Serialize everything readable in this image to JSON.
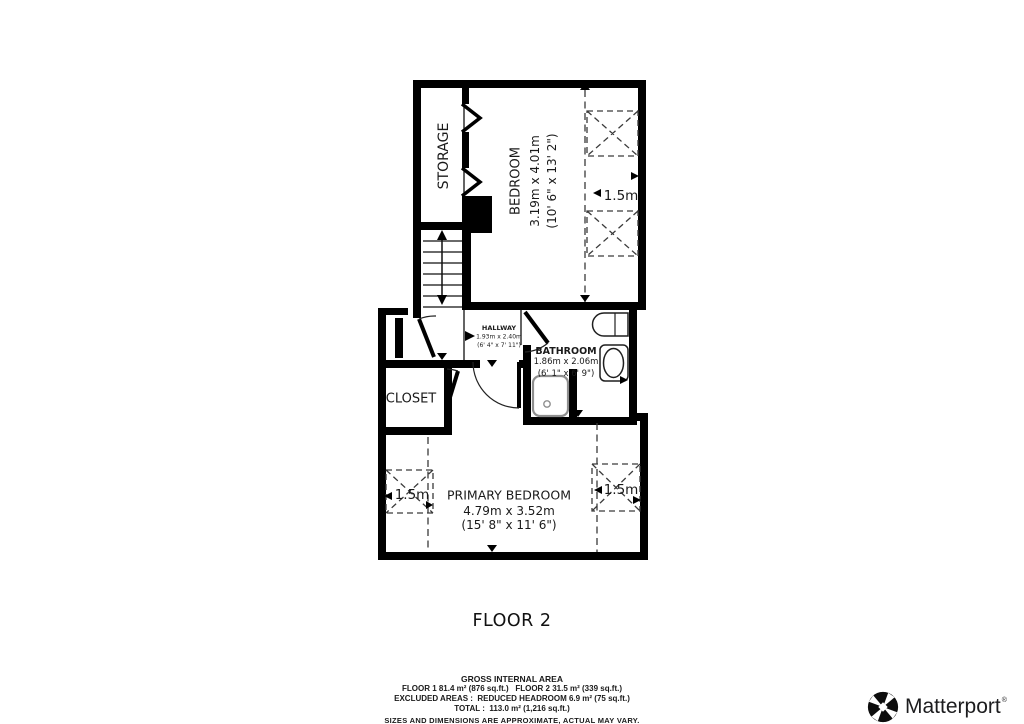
{
  "floor_plan": {
    "title": "FLOOR 2",
    "rooms": {
      "storage": {
        "name": "STORAGE"
      },
      "bedroom": {
        "name": "BEDROOM",
        "dimensions_metric": "3.19m x 4.01m",
        "dimensions_imperial": "(10' 6\" x 13' 2\")"
      },
      "hallway": {
        "name": "HALLWAY",
        "dimensions_metric": "1.93m x 2.40m",
        "dimensions_imperial": "(6' 4\" x 7' 11\")"
      },
      "bathroom": {
        "name": "BATHROOM",
        "dimensions_metric": "1.86m x 2.06m",
        "dimensions_imperial": "(6' 1\" x 6' 9\")"
      },
      "closet": {
        "name": "CLOSET"
      },
      "primary_bedroom": {
        "name": "PRIMARY BEDROOM",
        "dimensions_metric": "4.79m x 3.52m",
        "dimensions_imperial": "(15' 8\" x 11' 6\")"
      }
    },
    "ceiling_height_markers": {
      "bedroom": "1.5m",
      "primary_bedroom_left": "1.5m",
      "primary_bedroom_right": "1.5m"
    }
  },
  "area_summary": {
    "heading": "GROSS INTERNAL AREA",
    "floors_line": "FLOOR 1 81.4 m² (876 sq.ft.)   FLOOR 2 31.5 m² (339 sq.ft.)",
    "excluded_line": "EXCLUDED AREAS :  REDUCED HEADROOM 6.9 m² (75 sq.ft.)",
    "total_line": "TOTAL :  113.0 m² (1,216 sq.ft.)",
    "disclaimer": "SIZES AND DIMENSIONS ARE APPROXIMATE, ACTUAL MAY VARY."
  },
  "branding": {
    "name": "Matterport",
    "trademark": "®"
  },
  "colors": {
    "background": "#ffffff",
    "wall": "#000000",
    "text": "#1a1a1a",
    "dashed_line": "#3a3a3a",
    "shower_inner": "#8f8f8f"
  }
}
